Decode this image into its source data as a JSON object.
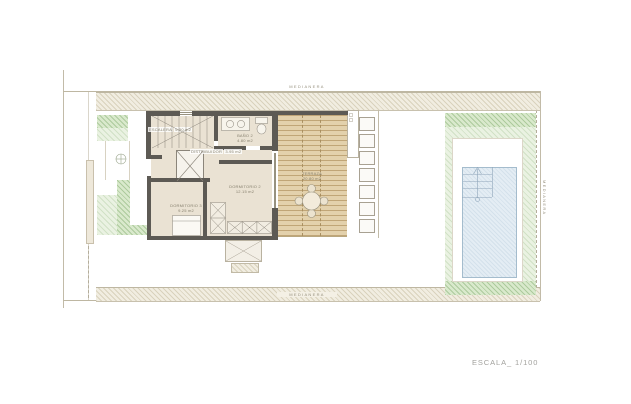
{
  "drawing": {
    "type": "architectural floor plan",
    "scale_label": "ESCALA_ 1/100"
  },
  "boundary_labels": {
    "top": "MEDIANERA",
    "bottom": "MEDIANERA",
    "right": "MEDIANERA"
  },
  "rooms": [
    {
      "name": "ESCALERA",
      "area": "5.50 m2"
    },
    {
      "name": "BAÑO 2",
      "area": "4.80 m2"
    },
    {
      "name": "DISTRIBUIDOR",
      "area": "3.95 m2"
    },
    {
      "name": "DORMITORIO 2",
      "area": "12.15 m2"
    },
    {
      "name": "DORMITORIO 3",
      "area": "9.25 m2"
    },
    {
      "name": "TERRAZA",
      "area": "20.80 m2"
    }
  ],
  "colors": {
    "wall": "#5d5a54",
    "room_floor": "#eae2d3",
    "terrace_deck": "#e3d1ac",
    "pool_water": "#e4edf4",
    "garden_green": "#d9e9cc",
    "boundary_hatch": "#f1ede1",
    "label_text": "#87816f"
  }
}
